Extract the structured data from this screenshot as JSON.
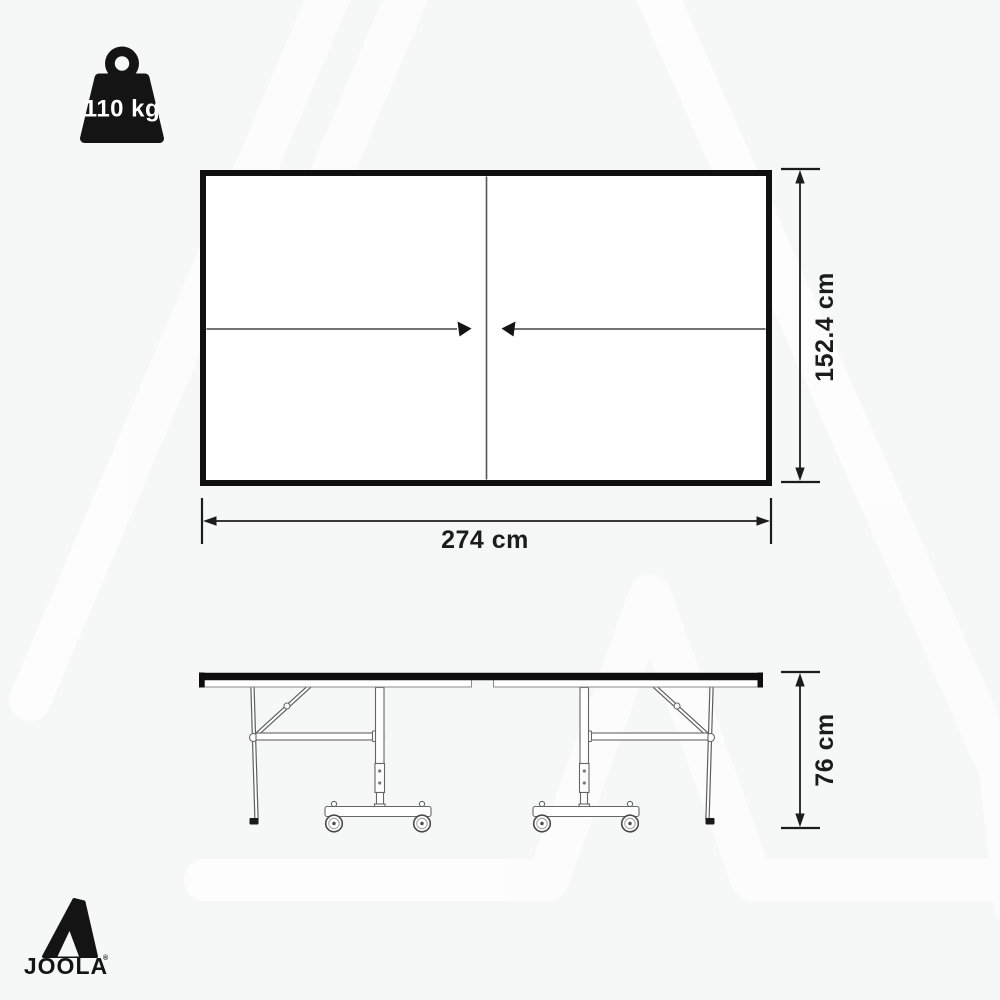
{
  "page": {
    "background_color": "#f6f7f7",
    "watermark": "joola-triangle-watermark",
    "description": "JOOLA table tennis table dimension diagram"
  },
  "weight_badge": {
    "icon": "weight-icon",
    "value": "110 kg",
    "color": "#141414",
    "text_color": "#ffffff"
  },
  "top_view": {
    "name": "table-top-view",
    "length_label": "274 cm",
    "width_label": "152.4 cm",
    "outline_color": "#101010",
    "fill_color": "#ffffff"
  },
  "side_view": {
    "name": "table-side-view",
    "height_label": "76 cm",
    "features": [
      "folding legs",
      "diagonal braces",
      "height adjusters",
      "transport wheel trolleys"
    ]
  },
  "brand": {
    "logo": "joola-triangle-logo",
    "wordmark": "JOOLA",
    "registered_mark": "®",
    "color": "#141414"
  },
  "product_dimensions": {
    "length_cm": 274,
    "width_cm": 152.4,
    "height_cm": 76,
    "weight_kg": 110
  }
}
